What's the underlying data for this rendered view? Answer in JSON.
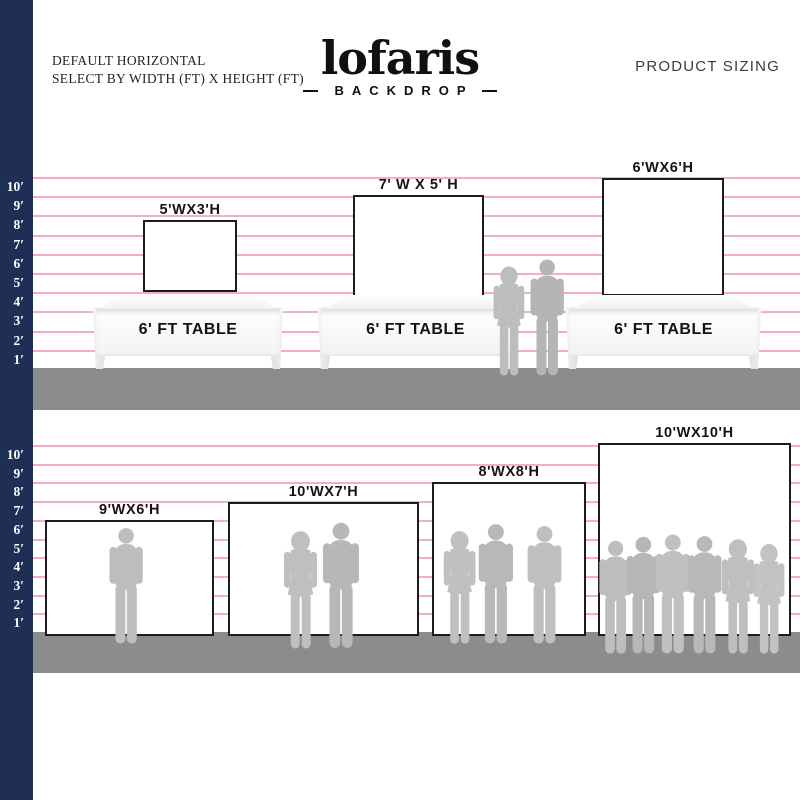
{
  "header": {
    "line1": "DEFAULT HORIZONTAL",
    "line2": "SELECT BY WIDTH (FT) X HEIGHT (FT)",
    "logo": "lofaris",
    "logo_sub": "BACKDROP",
    "right_title": "PRODUCT SIZING"
  },
  "ruler_labels": [
    "10′",
    "9′",
    "8′",
    "7′",
    "6′",
    "5′",
    "4′",
    "3′",
    "2′",
    "1′"
  ],
  "top_section": {
    "table_label": "6' FT TABLE",
    "backdrops": [
      {
        "label": "5'WX3'H",
        "width_ft": 5,
        "height_ft": 3
      },
      {
        "label": "7' W X 5' H",
        "width_ft": 7,
        "height_ft": 5
      },
      {
        "label": "6'WX6'H",
        "width_ft": 6,
        "height_ft": 6
      }
    ]
  },
  "bottom_section": {
    "backdrops": [
      {
        "label": "9'WX6'H",
        "width_ft": 9,
        "height_ft": 6
      },
      {
        "label": "10'WX7'H",
        "width_ft": 10,
        "height_ft": 7
      },
      {
        "label": "8'WX8'H",
        "width_ft": 8,
        "height_ft": 8
      },
      {
        "label": "10'WX10'H",
        "width_ft": 10,
        "height_ft": 10
      }
    ]
  },
  "colors": {
    "sidebar_navy": "#1f2e55",
    "gridline_pink": "#f3aec0",
    "floor_gray": "#8c8c8c",
    "silhouette_gray": "#bdbdbd",
    "backdrop_border": "#1c1c1c"
  }
}
